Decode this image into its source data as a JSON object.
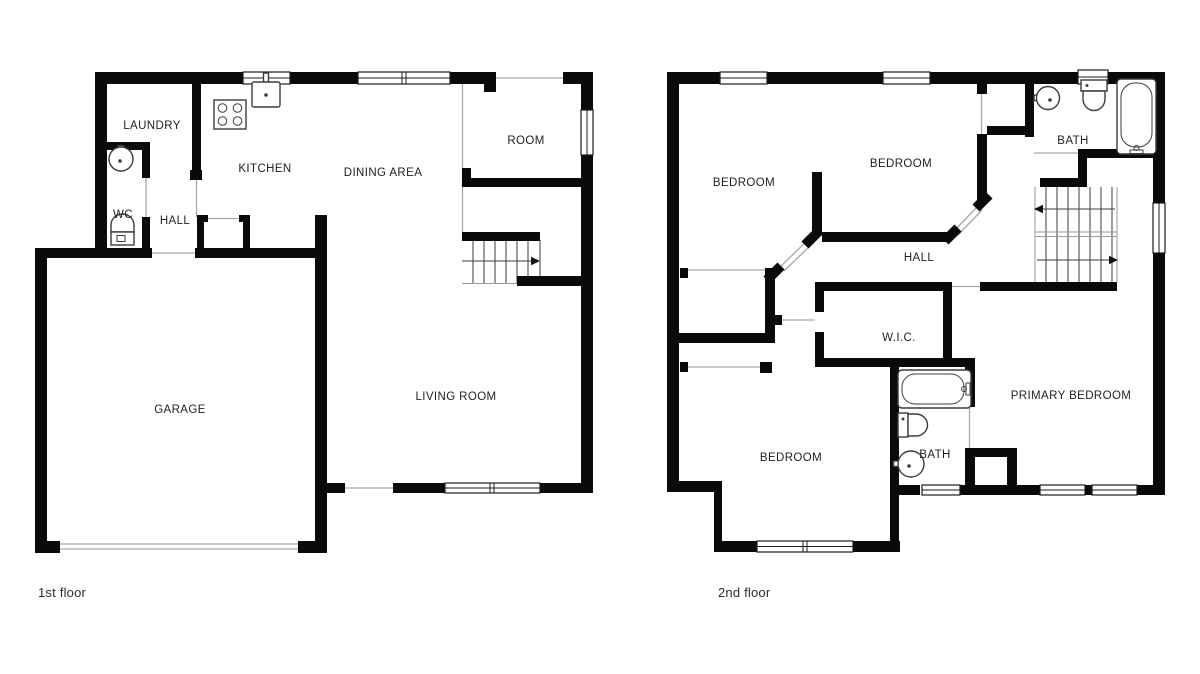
{
  "canvas": {
    "width": 1200,
    "height": 674,
    "background": "#ffffff"
  },
  "colors": {
    "wall": "#0a0a0a",
    "thin_line": "#a8a8a8",
    "stair_line": "#3d3d3d",
    "fixture_stroke": "#3c3c3c",
    "window_frame": "#1d1d1d",
    "label_text": "#1f1f1f",
    "caption_text": "#2b2b2b"
  },
  "floors": [
    {
      "caption": "1st floor",
      "rooms": [
        {
          "id": "laundry",
          "label": "LAUNDRY"
        },
        {
          "id": "kitchen",
          "label": "KITCHEN"
        },
        {
          "id": "dining-area",
          "label": "DINING AREA"
        },
        {
          "id": "room",
          "label": "ROOM"
        },
        {
          "id": "wc",
          "label": "WC"
        },
        {
          "id": "hall",
          "label": "HALL"
        },
        {
          "id": "garage",
          "label": "GARAGE"
        },
        {
          "id": "living-room",
          "label": "LIVING ROOM"
        }
      ],
      "fixtures": [
        "stove-icon",
        "kitchen-sink-icon",
        "round-sink-icon",
        "toilet-icon",
        "staircase-with-arrow"
      ]
    },
    {
      "caption": "2nd floor",
      "rooms": [
        {
          "id": "bedroom-nw",
          "label": "BEDROOM"
        },
        {
          "id": "bedroom-ne",
          "label": "BEDROOM"
        },
        {
          "id": "bath-upper",
          "label": "BATH"
        },
        {
          "id": "hall",
          "label": "HALL"
        },
        {
          "id": "wic",
          "label": "W.I.C."
        },
        {
          "id": "primary-bedroom",
          "label": "PRIMARY BEDROOM"
        },
        {
          "id": "bedroom-s",
          "label": "BEDROOM"
        },
        {
          "id": "bath-lower",
          "label": "BATH"
        }
      ],
      "fixtures": [
        "round-sink-icon",
        "toilet-icon",
        "bathtub-icon",
        "double-staircase-with-arrows",
        "bathtub-icon",
        "toilet-icon",
        "round-sink-icon"
      ]
    }
  ]
}
